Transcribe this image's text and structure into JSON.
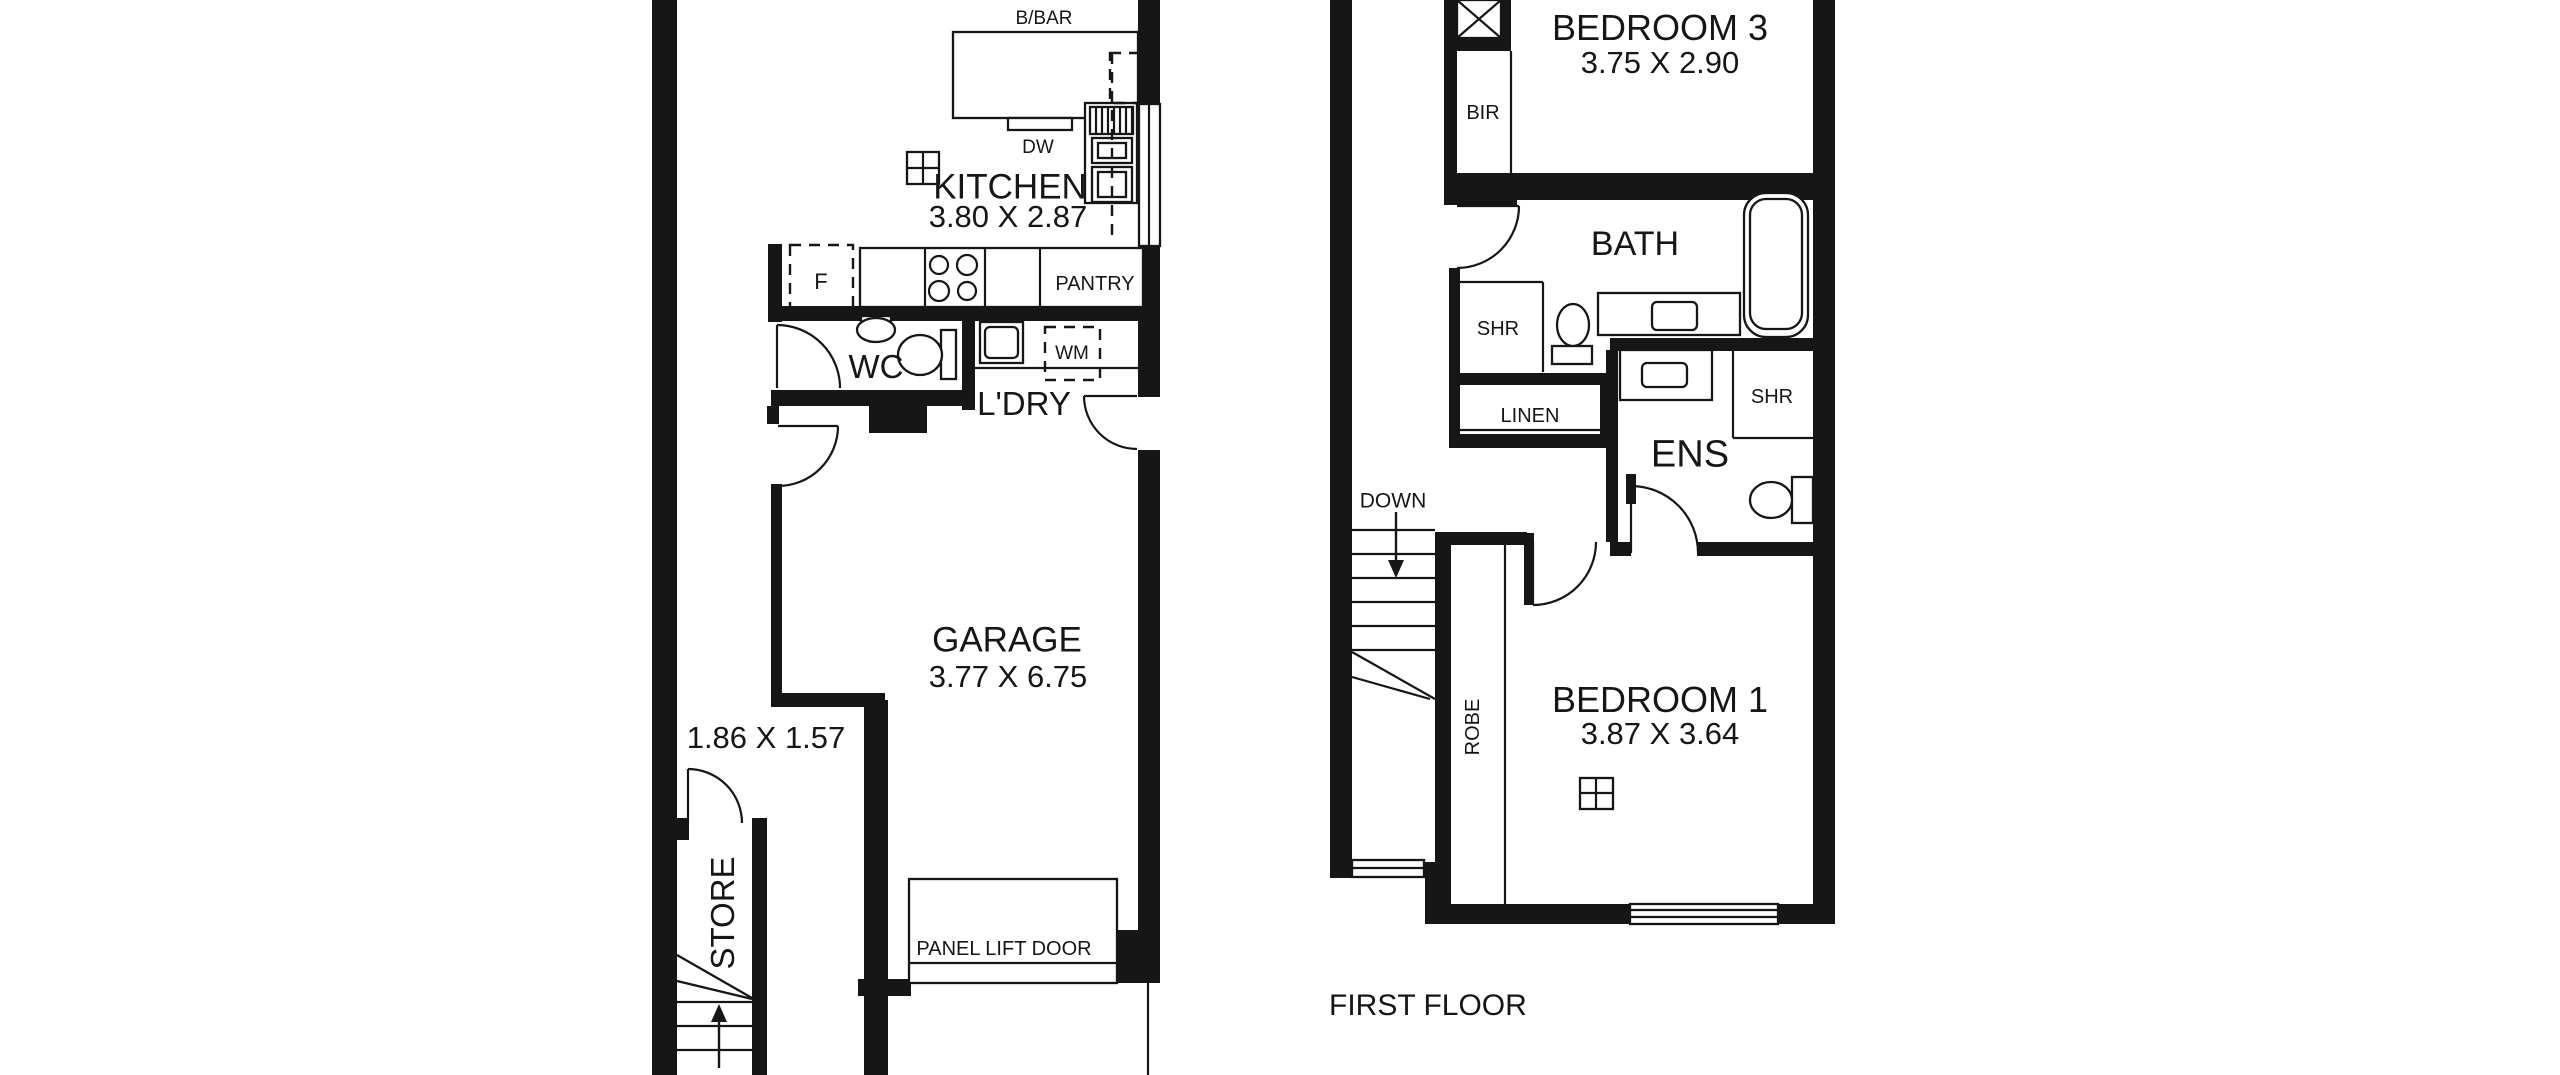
{
  "meta": {
    "bg": "#ffffff",
    "ink": "#161616",
    "width": 2560,
    "height": 1075
  },
  "floor_plan": {
    "ground_floor": {
      "rooms": [
        {
          "name": "KITCHEN",
          "dimensions": "3.80 X 2.87"
        },
        {
          "name": "WC"
        },
        {
          "name": "L'DRY"
        },
        {
          "name": "GARAGE",
          "dimensions": "3.77 X 6.75"
        },
        {
          "name": "STORE",
          "dimensions": "1.86 X 1.57"
        }
      ],
      "features": [
        "B/BAR",
        "DW",
        "F",
        "PANTRY",
        "WM",
        "PANEL LIFT DOOR",
        "UP"
      ]
    },
    "first_floor": {
      "label": "FIRST FLOOR",
      "rooms": [
        {
          "name": "BEDROOM 3",
          "dimensions": "3.75 X 2.90"
        },
        {
          "name": "BATH"
        },
        {
          "name": "ENS"
        },
        {
          "name": "LINEN"
        },
        {
          "name": "BEDROOM 1",
          "dimensions": "3.87 X 3.64"
        }
      ],
      "features": [
        "BIR",
        "SHR",
        "SHR",
        "DOWN",
        "ROBE"
      ]
    },
    "drawing": {
      "walls": [
        [
          652,
          0,
          25,
          1075
        ],
        [
          677,
          818,
          12,
          22
        ],
        [
          752,
          818,
          15,
          257
        ],
        [
          768,
          244,
          14,
          78
        ],
        [
          768,
          306,
          372,
          15
        ],
        [
          962,
          312,
          13,
          98
        ],
        [
          771,
          390,
          196,
          16
        ],
        [
          767,
          406,
          12,
          18
        ],
        [
          869,
          406,
          58,
          27
        ],
        [
          771,
          484,
          11,
          216
        ],
        [
          771,
          693,
          114,
          14
        ],
        [
          864,
          700,
          24,
          375
        ],
        [
          1138,
          0,
          22,
          106
        ],
        [
          1138,
          246,
          22,
          151
        ],
        [
          1138,
          450,
          22,
          480
        ],
        [
          1117,
          930,
          43,
          53
        ],
        [
          858,
          979,
          53,
          17
        ],
        [
          1330,
          0,
          22,
          878
        ],
        [
          1444,
          0,
          13,
          205
        ],
        [
          1501,
          0,
          10,
          38
        ],
        [
          1451,
          38,
          60,
          13
        ],
        [
          1445,
          173,
          390,
          27
        ],
        [
          1450,
          185,
          67,
          20
        ],
        [
          1813,
          0,
          22,
          924
        ],
        [
          1449,
          268,
          11,
          180
        ],
        [
          1456,
          373,
          150,
          12
        ],
        [
          1455,
          434,
          151,
          14
        ],
        [
          1600,
          385,
          14,
          63
        ],
        [
          1606,
          350,
          12,
          192
        ],
        [
          1610,
          338,
          203,
          13
        ],
        [
          1610,
          542,
          21,
          14
        ],
        [
          1697,
          542,
          116,
          14
        ],
        [
          1626,
          474,
          10,
          30
        ],
        [
          1435,
          532,
          16,
          392
        ],
        [
          1435,
          532,
          92,
          13
        ],
        [
          1524,
          533,
          10,
          72
        ],
        [
          1351,
          862,
          74,
          16
        ],
        [
          1425,
          862,
          19,
          62
        ],
        [
          1425,
          904,
          205,
          20
        ],
        [
          1778,
          904,
          57,
          20
        ]
      ],
      "outlines": [
        [
          953,
          32,
          185,
          86,
          0,
          "breakfast-bar-counter"
        ],
        [
          1008,
          118,
          64,
          12,
          0,
          "dishwasher"
        ],
        [
          1085,
          103,
          52,
          100,
          0,
          "oven-tower"
        ],
        [
          1090,
          107,
          43,
          27,
          0,
          "oven-grill"
        ],
        [
          1092,
          138,
          40,
          25,
          0,
          "oven-box"
        ],
        [
          1098,
          143,
          28,
          15,
          0,
          "oven-box-inner"
        ],
        [
          1092,
          167,
          40,
          35,
          0,
          "oven-box"
        ],
        [
          1098,
          172,
          28,
          25,
          0,
          "oven-box-inner"
        ],
        [
          860,
          248,
          283,
          59,
          0,
          "kitchen-bench"
        ],
        [
          907,
          152,
          32,
          32,
          0,
          "window-icon"
        ],
        [
          980,
          322,
          43,
          41,
          0,
          "laundry-tub"
        ],
        [
          985,
          327,
          33,
          31,
          5,
          "laundry-tub-inner"
        ],
        [
          909,
          879,
          208,
          104,
          0,
          "panel-lift-door"
        ],
        [
          861,
          316,
          30,
          9,
          0,
          "wc-basin-back"
        ],
        [
          941,
          330,
          15,
          49,
          0,
          "wc-cistern"
        ],
        [
          1139,
          104,
          21,
          142,
          0,
          "kitchen-window"
        ],
        [
          1352,
          860,
          72,
          17,
          0,
          "stair-window"
        ],
        [
          1630,
          904,
          148,
          20,
          0,
          "bedroom1-window"
        ],
        [
          1457,
          0,
          44,
          38,
          0,
          "void-xbox"
        ],
        [
          1598,
          293,
          142,
          42,
          0,
          "bath-vanity"
        ],
        [
          1652,
          302,
          45,
          28,
          5,
          "bath-sink"
        ],
        [
          1744,
          193,
          64,
          144,
          22,
          "bathtub"
        ],
        [
          1750,
          199,
          52,
          130,
          16,
          "bathtub-inner"
        ],
        [
          1552,
          346,
          40,
          18,
          0,
          "bath-cistern"
        ],
        [
          1620,
          350,
          92,
          50,
          0,
          "ens-vanity"
        ],
        [
          1642,
          363,
          45,
          24,
          5,
          "ens-sink"
        ],
        [
          1792,
          477,
          21,
          46,
          0,
          "ens-cistern"
        ],
        [
          1580,
          778,
          33,
          31,
          0,
          "window-icon"
        ]
      ],
      "ellipses": [
        [
          876,
          330,
          19,
          12,
          "wc-basin"
        ],
        [
          920,
          355,
          22,
          20,
          "wc-toilet-bowl"
        ],
        [
          1573,
          325,
          16,
          21,
          "bath-toilet-bowl"
        ],
        [
          1771,
          500,
          21,
          18,
          "ens-toilet-bowl"
        ]
      ],
      "circles": [
        [
          939,
          265,
          9
        ],
        [
          967,
          265,
          10
        ],
        [
          939,
          291,
          10
        ],
        [
          967,
          291,
          9
        ]
      ],
      "lines": [
        [
          925,
          248,
          925,
          307
        ],
        [
          985,
          248,
          985,
          307
        ],
        [
          1040,
          248,
          1040,
          307
        ],
        [
          972,
          368,
          1138,
          368
        ],
        [
          1149,
          104,
          1149,
          246
        ],
        [
          1096,
          107,
          1096,
          134
        ],
        [
          1102,
          107,
          1102,
          134
        ],
        [
          1108,
          107,
          1108,
          134
        ],
        [
          1114,
          107,
          1114,
          134
        ],
        [
          1120,
          107,
          1120,
          134
        ],
        [
          1126,
          107,
          1126,
          134
        ],
        [
          1132,
          107,
          1132,
          134
        ],
        [
          907,
          168,
          939,
          168
        ],
        [
          923,
          152,
          923,
          184
        ],
        [
          777,
          325,
          777,
          388
        ],
        [
          778,
          426,
          838,
          426
        ],
        [
          688,
          769,
          688,
          823
        ],
        [
          1084,
          396,
          1137,
          396
        ],
        [
          677,
          1002,
          752,
          1002
        ],
        [
          677,
          1026,
          752,
          1026
        ],
        [
          677,
          1050,
          752,
          1050
        ],
        [
          677,
          955,
          752,
          998
        ],
        [
          677,
          981,
          752,
          999
        ],
        [
          909,
          963,
          1117,
          963
        ],
        [
          1148,
          983,
          1148,
          1075
        ],
        [
          1511,
          51,
          1511,
          173
        ],
        [
          1505,
          545,
          1505,
          904
        ],
        [
          1458,
          282,
          1543,
          282
        ],
        [
          1543,
          282,
          1543,
          372
        ],
        [
          1733,
          350,
          1733,
          438
        ],
        [
          1733,
          438,
          1813,
          438
        ],
        [
          1456,
          430,
          1606,
          430
        ],
        [
          1352,
          530,
          1435,
          530
        ],
        [
          1352,
          554,
          1435,
          554
        ],
        [
          1352,
          578,
          1435,
          578
        ],
        [
          1352,
          602,
          1435,
          602
        ],
        [
          1352,
          626,
          1435,
          626
        ],
        [
          1352,
          650,
          1435,
          650
        ],
        [
          1352,
          652,
          1435,
          699
        ],
        [
          1352,
          677,
          1430,
          699
        ],
        [
          1457,
          206,
          1519,
          206
        ],
        [
          1631,
          486,
          1631,
          553
        ],
        [
          1533,
          542,
          1533,
          605
        ],
        [
          1630,
          910,
          1778,
          910
        ],
        [
          1630,
          917,
          1778,
          917
        ],
        [
          1352,
          868,
          1424,
          868
        ],
        [
          1457,
          0,
          1501,
          38
        ],
        [
          1501,
          0,
          1457,
          38
        ],
        [
          1580,
          793,
          1613,
          793
        ],
        [
          1596,
          778,
          1596,
          809
        ]
      ],
      "dashed_rects": [
        [
          790,
          245,
          63,
          66,
          "fridge-space"
        ],
        [
          1045,
          327,
          55,
          53,
          "washing-machine-space"
        ],
        [
          1110,
          53,
          30,
          50,
          "overhead-cupboard"
        ]
      ],
      "dashed_lines": [
        [
          1112,
          53,
          1112,
          243
        ]
      ],
      "arcs": [
        {
          "d": "M 777 325 A 63 63 0 0 1 840 388",
          "n": "wc-door-arc"
        },
        {
          "d": "M 838 426 A 60 60 0 0 1 778 486",
          "n": "garage-door-arc"
        },
        {
          "d": "M 688 769 A 54 54 0 0 1 742 823",
          "n": "store-door-arc"
        },
        {
          "d": "M 1084 396 A 53 53 0 0 0 1137 449",
          "n": "laundry-door-arc"
        },
        {
          "d": "M 1519 206 A 62 62 0 0 1 1457 268",
          "n": "bath-door-arc"
        },
        {
          "d": "M 1631 486 A 67 67 0 0 1 1698 553",
          "n": "ens-door-arc"
        },
        {
          "d": "M 1533 605 A 63 63 0 0 0 1596 542",
          "n": "bedroom1-door-arc"
        }
      ],
      "arrows": [
        {
          "shaft": [
            719,
            1068,
            719,
            1014
          ],
          "head": "719,1004 711,1022 727,1022",
          "n": "stairs-up-arrow"
        },
        {
          "shaft": [
            1396,
            512,
            1396,
            564
          ],
          "head": "1396,578 1388,560 1404,560",
          "n": "stairs-down-arrow"
        }
      ],
      "texts": [
        {
          "t": "B/BAR",
          "x": 1044,
          "y": 17,
          "s": 19,
          "n": "label-breakfast-bar"
        },
        {
          "t": "DW",
          "x": 1038,
          "y": 146,
          "s": 19,
          "n": "label-dishwasher"
        },
        {
          "t": "KITCHEN",
          "x": 1010,
          "y": 186,
          "s": 35,
          "n": "room-label-kitchen"
        },
        {
          "t": "3.80 X 2.87",
          "x": 1008,
          "y": 216,
          "s": 31,
          "n": "dims-kitchen"
        },
        {
          "t": "F",
          "x": 821,
          "y": 281,
          "s": 22,
          "n": "label-fridge"
        },
        {
          "t": "PANTRY",
          "x": 1095,
          "y": 283,
          "s": 20,
          "n": "label-pantry"
        },
        {
          "t": "WC",
          "x": 876,
          "y": 366,
          "s": 33,
          "n": "room-label-wc"
        },
        {
          "t": "WM",
          "x": 1072,
          "y": 352,
          "s": 19,
          "n": "label-washing-machine"
        },
        {
          "t": "L'DRY",
          "x": 1024,
          "y": 403,
          "s": 33,
          "n": "room-label-laundry"
        },
        {
          "t": "GARAGE",
          "x": 1007,
          "y": 639,
          "s": 35,
          "n": "room-label-garage"
        },
        {
          "t": "3.77 X 6.75",
          "x": 1008,
          "y": 676,
          "s": 31,
          "n": "dims-garage"
        },
        {
          "t": "1.86 X 1.57",
          "x": 766,
          "y": 737,
          "s": 31,
          "n": "dims-store"
        },
        {
          "t": "STORE",
          "x": 722,
          "y": 913,
          "s": 33,
          "r": -90,
          "n": "room-label-store"
        },
        {
          "t": "PANEL LIFT DOOR",
          "x": 1004,
          "y": 948,
          "s": 20,
          "n": "label-panel-lift-door"
        },
        {
          "t": "UP",
          "x": 789,
          "y": 1084,
          "s": 22,
          "n": "label-stairs-up"
        },
        {
          "t": "BEDROOM 3",
          "x": 1660,
          "y": 27,
          "s": 36,
          "n": "room-label-bedroom3"
        },
        {
          "t": "3.75 X 2.90",
          "x": 1660,
          "y": 62,
          "s": 31,
          "n": "dims-bedroom3"
        },
        {
          "t": "BIR",
          "x": 1483,
          "y": 112,
          "s": 20,
          "n": "label-bir"
        },
        {
          "t": "BATH",
          "x": 1635,
          "y": 243,
          "s": 34,
          "n": "room-label-bath"
        },
        {
          "t": "SHR",
          "x": 1498,
          "y": 328,
          "s": 20,
          "n": "label-shower-bath"
        },
        {
          "t": "LINEN",
          "x": 1530,
          "y": 415,
          "s": 20,
          "n": "label-linen"
        },
        {
          "t": "SHR",
          "x": 1772,
          "y": 396,
          "s": 20,
          "n": "label-shower-ens"
        },
        {
          "t": "ENS",
          "x": 1690,
          "y": 453,
          "s": 38,
          "n": "room-label-ens"
        },
        {
          "t": "DOWN",
          "x": 1393,
          "y": 500,
          "s": 21,
          "n": "label-stairs-down"
        },
        {
          "t": "ROBE",
          "x": 1472,
          "y": 727,
          "s": 20,
          "r": -90,
          "n": "label-robe"
        },
        {
          "t": "BEDROOM 1",
          "x": 1660,
          "y": 699,
          "s": 36,
          "n": "room-label-bedroom1"
        },
        {
          "t": "3.87 X 3.64",
          "x": 1660,
          "y": 733,
          "s": 31,
          "n": "dims-bedroom1"
        },
        {
          "t": "FIRST FLOOR",
          "x": 1329,
          "y": 1004,
          "s": 30,
          "a": "start",
          "n": "floor-title-first-floor"
        }
      ]
    }
  }
}
